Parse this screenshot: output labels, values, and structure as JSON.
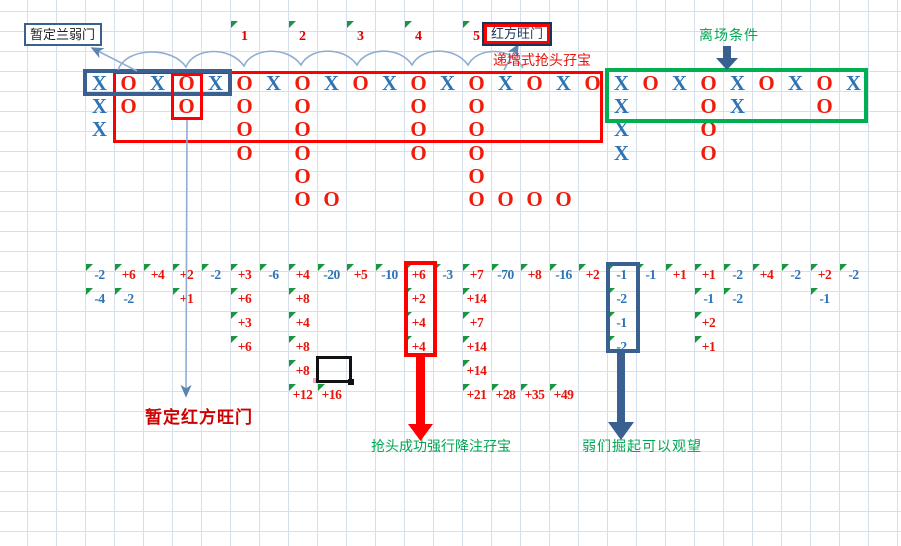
{
  "colors": {
    "x_blue": "#2e74b5",
    "o_red": "#ee1c0c",
    "pos_red": "#e8140c",
    "neg_blue": "#2e74b5",
    "triangle_green": "#1a9641",
    "navy": "#3a5f91",
    "label_navy": "#17365d",
    "red": "#fe0000",
    "green": "#00b050",
    "green_text": "#00a651",
    "dark_red_text": "#cc0000",
    "leader_blue": "#8fadd1",
    "grid_line": "#d6e0ec",
    "seq_red": "#e00000"
  },
  "annotations": {
    "weak_door_label": "暂定兰弱门",
    "hot_door_label": "红方旺门",
    "incremental_label": "递增式抢头孖宝",
    "exit_label": "离场条件",
    "tentative_hot_label": "暂定红方旺门",
    "grab_success_label": "抢头成功强行降注孖宝",
    "weak_rise_label": "弱们掘起可以观望"
  },
  "sequence_markers": [
    {
      "col": 5,
      "label": "1"
    },
    {
      "col": 7,
      "label": "2"
    },
    {
      "col": 9,
      "label": "3"
    },
    {
      "col": 11,
      "label": "4"
    },
    {
      "col": 13,
      "label": "5"
    }
  ],
  "xo_rows": [
    [
      [
        0,
        "X"
      ],
      [
        1,
        "O"
      ],
      [
        2,
        "X"
      ],
      [
        3,
        "O"
      ],
      [
        4,
        "X"
      ],
      [
        5,
        "O"
      ],
      [
        6,
        "X"
      ],
      [
        7,
        "O"
      ],
      [
        8,
        "X"
      ],
      [
        9,
        "O"
      ],
      [
        10,
        "X"
      ],
      [
        11,
        "O"
      ],
      [
        12,
        "X"
      ],
      [
        13,
        "O"
      ],
      [
        14,
        "X"
      ],
      [
        15,
        "O"
      ],
      [
        16,
        "X"
      ],
      [
        17,
        "O"
      ],
      [
        18,
        "X"
      ],
      [
        19,
        "O"
      ],
      [
        20,
        "X"
      ],
      [
        21,
        "O"
      ],
      [
        22,
        "X"
      ],
      [
        23,
        "O"
      ],
      [
        24,
        "X"
      ],
      [
        25,
        "O"
      ],
      [
        26,
        "X"
      ]
    ],
    [
      [
        0,
        "X"
      ],
      [
        1,
        "O"
      ],
      [
        3,
        "O"
      ],
      [
        5,
        "O"
      ],
      [
        7,
        "O"
      ],
      [
        11,
        "O"
      ],
      [
        13,
        "O"
      ],
      [
        18,
        "X"
      ],
      [
        21,
        "O"
      ],
      [
        22,
        "X"
      ],
      [
        25,
        "O"
      ]
    ],
    [
      [
        0,
        "X"
      ],
      [
        5,
        "O"
      ],
      [
        7,
        "O"
      ],
      [
        11,
        "O"
      ],
      [
        13,
        "O"
      ],
      [
        18,
        "X"
      ],
      [
        21,
        "O"
      ]
    ],
    [
      [
        5,
        "O"
      ],
      [
        7,
        "O"
      ],
      [
        11,
        "O"
      ],
      [
        13,
        "O"
      ],
      [
        18,
        "X"
      ],
      [
        21,
        "O"
      ]
    ],
    [
      [
        7,
        "O"
      ],
      [
        13,
        "O"
      ]
    ],
    [
      [
        7,
        "O"
      ],
      [
        8,
        "O"
      ],
      [
        13,
        "O"
      ],
      [
        14,
        "O"
      ],
      [
        15,
        "O"
      ],
      [
        16,
        "O"
      ]
    ]
  ],
  "num_rows": [
    [
      [
        0,
        "-2"
      ],
      [
        1,
        "+6"
      ],
      [
        2,
        "+4"
      ],
      [
        3,
        "+2"
      ],
      [
        4,
        "-2"
      ],
      [
        5,
        "+3"
      ],
      [
        6,
        "-6"
      ],
      [
        7,
        "+4"
      ],
      [
        8,
        "-20"
      ],
      [
        9,
        "+5"
      ],
      [
        10,
        "-10"
      ],
      [
        11,
        "+6"
      ],
      [
        12,
        "-3"
      ],
      [
        13,
        "+7"
      ],
      [
        14,
        "-70"
      ],
      [
        15,
        "+8"
      ],
      [
        16,
        "-16"
      ],
      [
        17,
        "+2"
      ],
      [
        18,
        "-1"
      ],
      [
        19,
        "-1"
      ],
      [
        20,
        "+1"
      ],
      [
        21,
        "+1"
      ],
      [
        22,
        "-2"
      ],
      [
        23,
        "+4"
      ],
      [
        24,
        "-2"
      ],
      [
        25,
        "+2"
      ],
      [
        26,
        "-2"
      ]
    ],
    [
      [
        0,
        "-4"
      ],
      [
        1,
        "-2"
      ],
      [
        3,
        "+1"
      ],
      [
        5,
        "+6"
      ],
      [
        7,
        "+8"
      ],
      [
        11,
        "+2"
      ],
      [
        13,
        "+14"
      ],
      [
        18,
        "-2"
      ],
      [
        21,
        "-1"
      ],
      [
        22,
        "-2"
      ],
      [
        25,
        "-1"
      ]
    ],
    [
      [
        5,
        "+3"
      ],
      [
        7,
        "+4"
      ],
      [
        11,
        "+4"
      ],
      [
        13,
        "+7"
      ],
      [
        18,
        "-1"
      ],
      [
        21,
        "+2"
      ]
    ],
    [
      [
        5,
        "+6"
      ],
      [
        7,
        "+8"
      ],
      [
        11,
        "+4"
      ],
      [
        13,
        "+14"
      ],
      [
        18,
        "-2"
      ],
      [
        21,
        "+1"
      ]
    ],
    [
      [
        7,
        "+8"
      ],
      [
        13,
        "+14"
      ]
    ],
    [
      [
        7,
        "+12"
      ],
      [
        8,
        "+16"
      ],
      [
        13,
        "+21"
      ],
      [
        14,
        "+28"
      ],
      [
        15,
        "+35"
      ],
      [
        16,
        "+49"
      ]
    ]
  ]
}
